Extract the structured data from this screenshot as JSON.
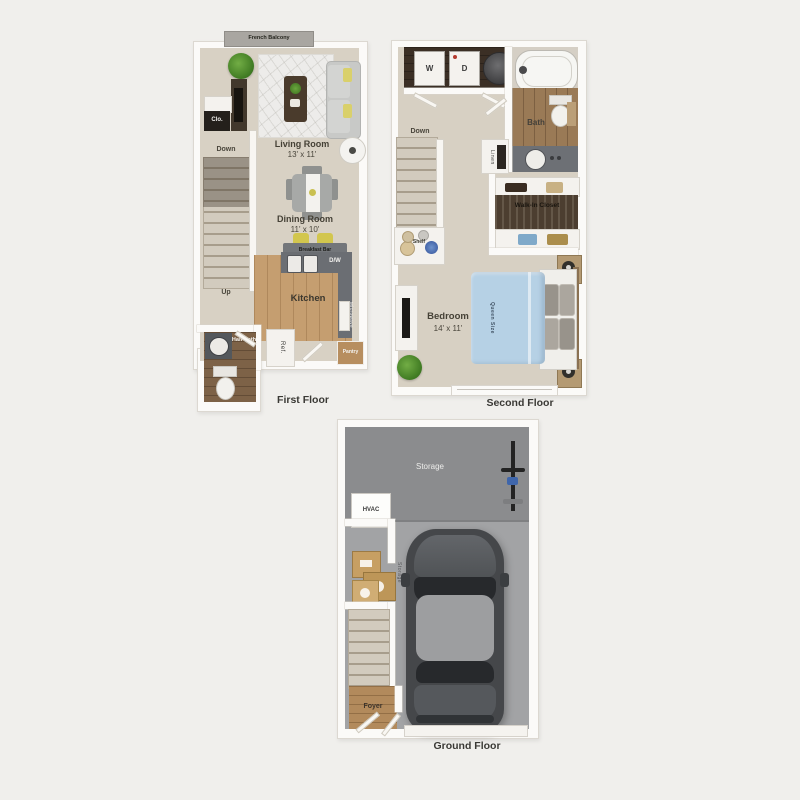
{
  "title": "Townhouse floor plan — three levels",
  "colors": {
    "background": "#f0efec",
    "walls": "#fbfaf8",
    "carpet_beige": "#d8d1c4",
    "kitchen_wood": "#c59e70",
    "bath_wood": "#9a7a56",
    "dark_closet": "#3b2f25",
    "walk_in_closet": "#4c3e30",
    "counter_gray": "#6b6e73",
    "storage_gray": "#8b8c8e",
    "garage_gray": "#a2a3a5",
    "bed_blue": "#b6d1e5",
    "accent_yellow": "#d2c64e"
  },
  "first_floor": {
    "caption": "First Floor",
    "balcony": "French Balcony",
    "closet": "Clo.",
    "stairs_down": "Down",
    "stairs_up": "Up",
    "living_room": {
      "name": "Living Room",
      "dimensions": "13' x 11'"
    },
    "dining_room": {
      "name": "Dining Room",
      "dimensions": "11' x 10'"
    },
    "breakfast_bar": "Breakfast Bar",
    "dishwasher": "D/W",
    "kitchen": {
      "name": "Kitchen"
    },
    "microwave": "Microwave",
    "pantry": "Pantry",
    "refrigerator": "Ref.",
    "half_bath": "Half Bath"
  },
  "second_floor": {
    "caption": "Second Floor",
    "washer": "W",
    "dryer": "D",
    "bath": "Bath",
    "stairs_down": "Down",
    "linen": "Linen",
    "walk_in_closet": "Walk-In Closet",
    "shelf": "Shelf",
    "bedroom": {
      "name": "Bedroom",
      "dimensions": "14' x 11'"
    },
    "bed": "Queen Size"
  },
  "ground_floor": {
    "caption": "Ground Floor",
    "storage_area": "Storage",
    "hvac": "HVAC",
    "storage_boxes": "Storage",
    "foyer": "Foyer"
  }
}
